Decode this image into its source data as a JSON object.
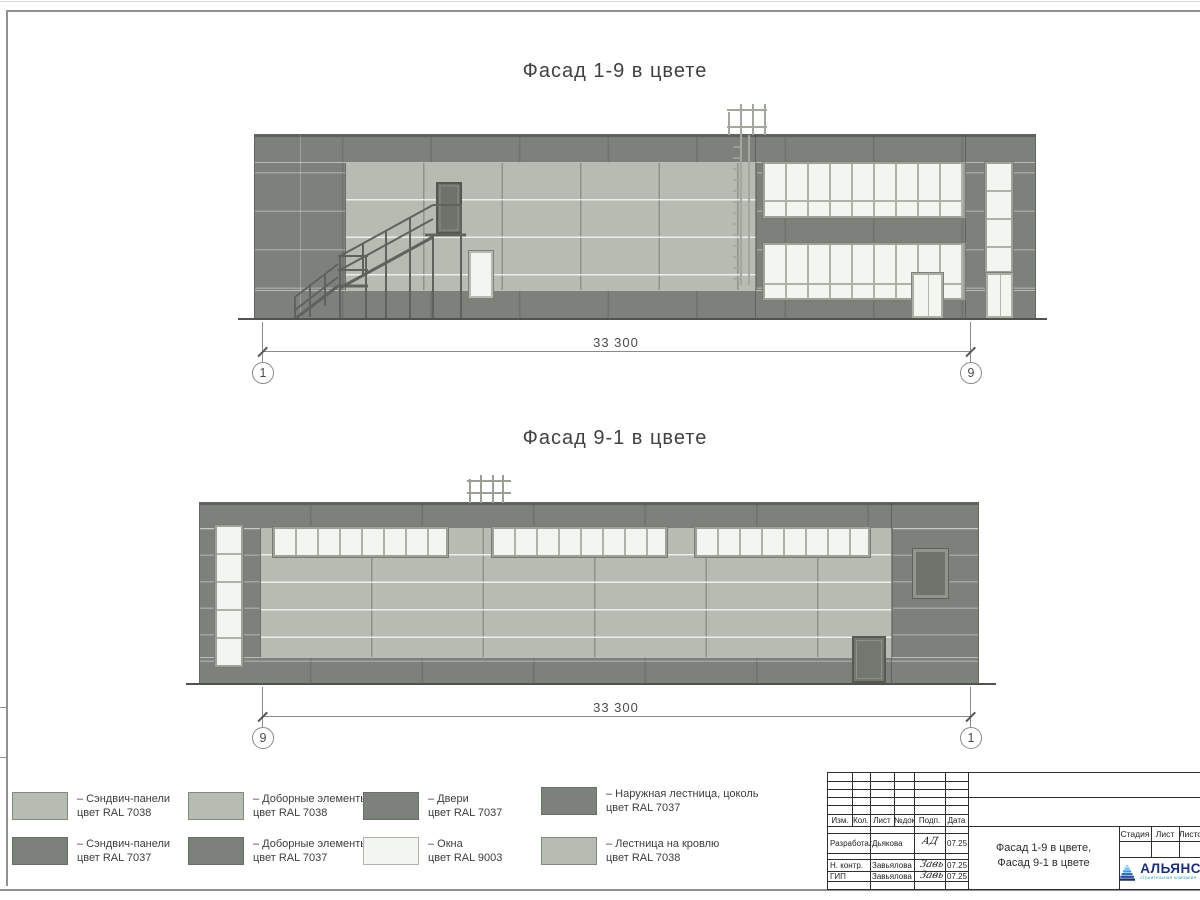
{
  "colors": {
    "panel_dark_ral7037": "#7d817b",
    "panel_light_ral7038": "#b7bcb2",
    "window_ral9003": "#f3f6f0",
    "outline": "#63665f",
    "mullion": "#aeb3aa",
    "win_frame": "#9da39b",
    "stair": "#5f635d",
    "ladder": "#a3a89f",
    "dim": "#8a8a8a",
    "text": "#3c3e3b",
    "tb_line": "#2f2f2f",
    "logo_navy": "#1c2f76",
    "logo_teal": "#2aa0ad"
  },
  "facade_top": {
    "title": "Фасад 1-9 в цвете",
    "dim_value": "33 300",
    "axis_left": "1",
    "axis_right": "9"
  },
  "facade_bottom": {
    "title": "Фасад 9-1 в цвете",
    "dim_value": "33 300",
    "axis_left": "9",
    "axis_right": "1"
  },
  "legend": {
    "items": [
      {
        "line1": "– Сэндвич-панели",
        "line2": "цвет RAL 7038"
      },
      {
        "line1": "– Сэндвич-панели",
        "line2": "цвет RAL 7037"
      },
      {
        "line1": "– Доборные элементы",
        "line2": "цвет RAL 7038"
      },
      {
        "line1": "– Доборные элементы",
        "line2": "цвет RAL 7037"
      },
      {
        "line1": "– Двери",
        "line2": "цвет RAL 7037"
      },
      {
        "line1": "– Окна",
        "line2": "цвет RAL 9003"
      },
      {
        "line1": "– Наружная лестница, цоколь",
        "line2": "цвет RAL 7037"
      },
      {
        "line1": "– Лестница на кровлю",
        "line2": "цвет RAL 7038"
      }
    ]
  },
  "titleblock": {
    "col_headers": [
      "Изм.",
      "Кол.",
      "Лист",
      "№док",
      "Подп.",
      "Дата"
    ],
    "rows": [
      {
        "role": "Разработал",
        "name": "Дьякова",
        "sig": "АД",
        "date": "07.25"
      },
      {
        "role": "Н. контр.",
        "name": "Завьялова",
        "sig": "Завь",
        "date": "07.25"
      },
      {
        "role": "ГИП",
        "name": "Завьялова",
        "sig": "Завь",
        "date": "07.25"
      }
    ],
    "stage_headers": [
      "Стадия",
      "Лист",
      "Листов"
    ],
    "doc_title_line1": "Фасад 1-9 в цвете,",
    "doc_title_line2": "Фасад 9-1 в цвете",
    "logo_text": "АЛЬЯНС",
    "logo_subtext": "строительная компания"
  }
}
